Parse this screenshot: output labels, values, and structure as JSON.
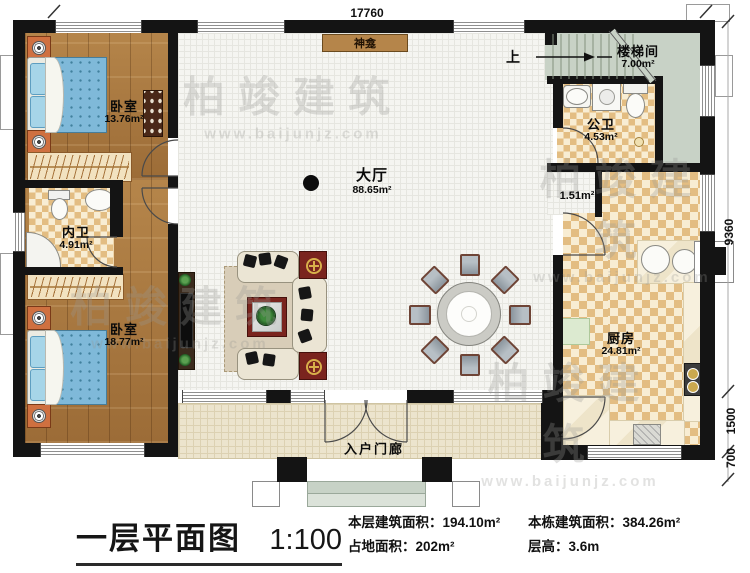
{
  "plan": {
    "rooms": {
      "bedroom1": {
        "name": "卧室",
        "area": "13.76m²"
      },
      "innerBath": {
        "name": "内卫",
        "area": "4.91m²"
      },
      "bedroom2": {
        "name": "卧室",
        "area": "18.77m²"
      },
      "hall": {
        "name": "大厅",
        "area": "88.65m²"
      },
      "stairwell": {
        "name": "楼梯间",
        "area": "7.00m²"
      },
      "publicBath": {
        "name": "公卫",
        "area": "4.53m²"
      },
      "kitchen": {
        "name": "厨房",
        "area": "24.81m²"
      },
      "corridor": {
        "area": "1.51m²"
      },
      "porch": {
        "name": "入户门廊"
      },
      "shrine": {
        "name": "神龛"
      },
      "stairs": {
        "direction": "上"
      }
    },
    "dimensions": {
      "overallWidth": "17760",
      "overallDepth": "9360",
      "porchDepth": "1500",
      "stepDepth": "700"
    }
  },
  "titleBlock": {
    "title": "一层平面图",
    "scale": "1:100",
    "stats": [
      {
        "label": "本层建筑面积：",
        "value": "194.10m²"
      },
      {
        "label": "占地面积：",
        "value": "202m²"
      },
      {
        "label": "本栋建筑面积：",
        "value": "384.26m²"
      },
      {
        "label": "层高：",
        "value": "3.6m"
      }
    ]
  },
  "watermark": {
    "brand": "柏竣建筑",
    "url": "www.baijunjz.com"
  },
  "colors": {
    "wall": "#141414",
    "woodFloor": "#a9783c",
    "tileChecker": "#e3bd82",
    "stairFloor": "#c8d2c6",
    "accentRed": "#7a241e",
    "bedBlue": "#7fb9d9",
    "shrineBrown": "#b5854a"
  }
}
